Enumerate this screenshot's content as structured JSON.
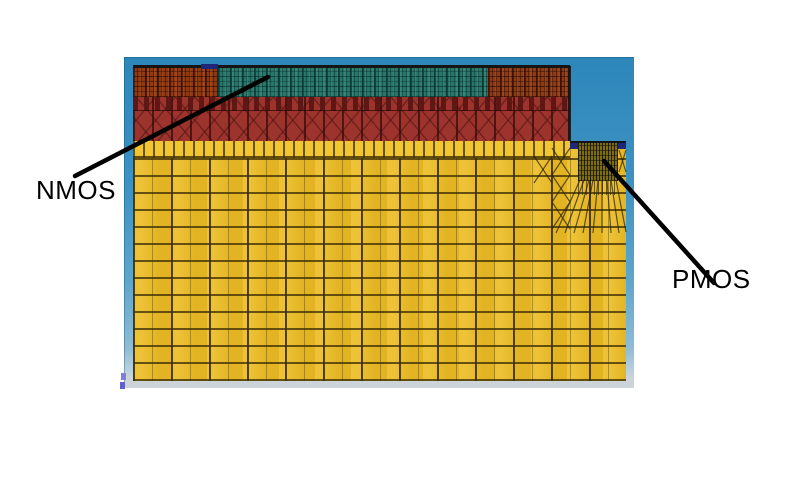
{
  "annotations": {
    "nmos_label": "NMOS",
    "pmos_label": "PMOS"
  },
  "figure": {
    "kind": "semiconductor-device-mesh-cross-section",
    "regions": [
      {
        "name": "viewer-background",
        "color": "#2d86ba"
      },
      {
        "name": "substrate-mesh",
        "color": "#eaba24"
      },
      {
        "name": "nmos-body-mesh",
        "color": "#9c332d"
      },
      {
        "name": "nmos-gate-strip",
        "color": "#27786c"
      },
      {
        "name": "nmos-source-drain-strips",
        "color": "#8e3a13"
      },
      {
        "name": "pmos-contact-bars",
        "color": "#1e2778"
      },
      {
        "name": "pmos-gate-mesh",
        "color": "#7c6c12"
      }
    ]
  },
  "theme": {
    "--bg-page": "#ffffff",
    "--vp-blue-top": "#2d86ba",
    "--vp-frame": "#ccd3d9",
    "--substrate": "#eaba24",
    "--substrate-bright": "#f2c630",
    "--brick": "#9c332d",
    "--brick-dark": "#5e1713",
    "--rust": "#8e3a13",
    "--teal": "#27786c",
    "--navy": "#1e2778",
    "--olive": "#7c6c12",
    "--annotation": "#000000",
    "--corner-glyph": "#7d7fd8"
  }
}
